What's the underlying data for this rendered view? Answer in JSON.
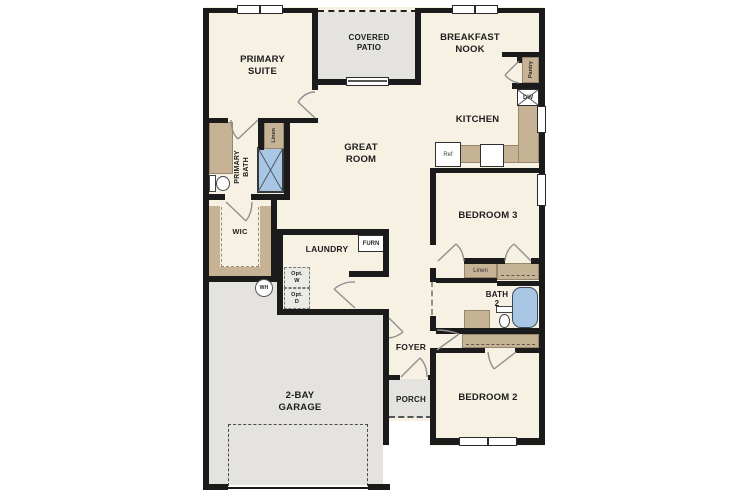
{
  "colors": {
    "wall": "#1b1b1b",
    "floor": "#f7f1e4",
    "outdoor": "#e4e3df",
    "cabinet": "#c6b294",
    "fixture": "#a9c7e3",
    "door": "#8f8f8f",
    "ink": "#1d1d1d"
  },
  "labels": {
    "primary_suite": "PRIMARY\nSUITE",
    "covered_patio": "COVERED\nPATIO",
    "breakfast_nook": "BREAKFAST\nNOOK",
    "kitchen": "KITCHEN",
    "great_room": "GREAT\nROOM",
    "primary_bath": "PRIMARY\nBATH",
    "wic": "WIC",
    "laundry": "LAUNDRY",
    "bedroom_3": "BEDROOM 3",
    "bath_2": "BATH\n2",
    "bedroom_2": "BEDROOM 2",
    "foyer": "FOYER",
    "porch": "PORCH",
    "garage": "2-BAY\nGARAGE"
  },
  "fixtures": {
    "pantry": "Pantry",
    "linen_primary": "Linen",
    "linen_hall": "Linen",
    "dishwasher": "DW",
    "refrigerator": "Ref",
    "furnace": "FURN",
    "opt_washer": "Opt.\nW",
    "opt_dryer": "Opt.\nD",
    "water_heater": "WH"
  }
}
